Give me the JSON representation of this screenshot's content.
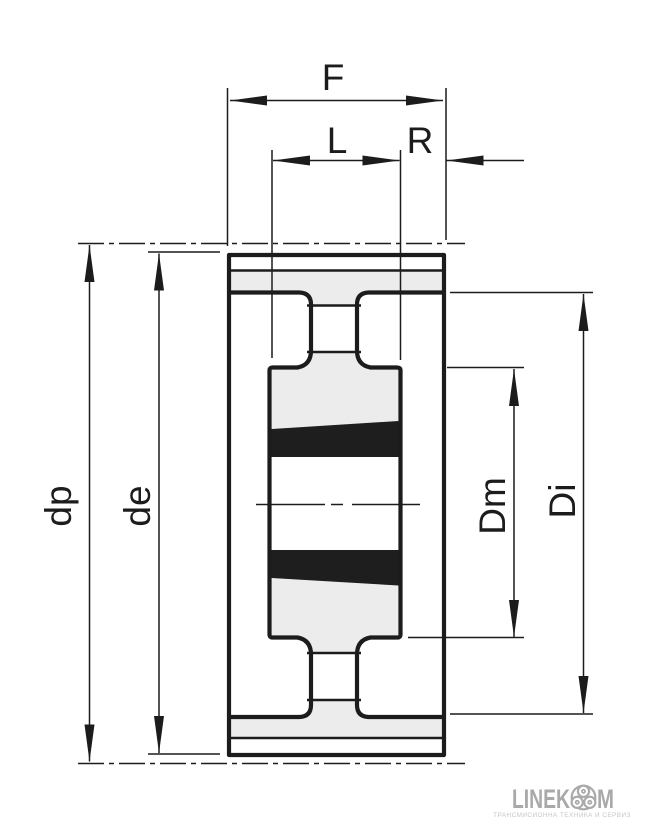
{
  "drawing": {
    "kind": "technical cross-section of a toothed belt pulley with taper bushing",
    "dimension_labels": {
      "F": "F",
      "L": "L",
      "R": "R",
      "dp": "dp",
      "de": "de",
      "Dm": "Dm",
      "Di": "Di"
    }
  },
  "logo": {
    "text_left": "LINEK",
    "text_right": "M",
    "symbol": "three-circles-pulley-icon",
    "tagline": "ТРАНСМИСИОННА ТЕХНИКА И СЕРВИЗ"
  },
  "colors": {
    "line": "#1c1c1c",
    "gray": "#ececec",
    "wedge": "#1e1e1e",
    "logogray": "#a9a9a9",
    "taglinegray": "#c6c6c6",
    "background": "#ffffff"
  }
}
